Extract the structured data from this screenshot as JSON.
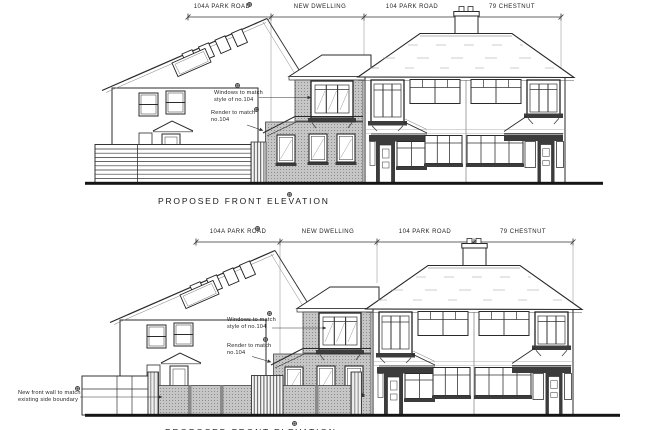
{
  "document": {
    "type": "architectural-elevation-drawing",
    "colors": {
      "line": "#2a2a2a",
      "render_gray": "#c6c6c6",
      "dark_band": "#3c3c3c",
      "ground": "#151515"
    },
    "panels": [
      {
        "title": "PROPOSED FRONT ELEVATION",
        "dimension_labels": [
          "104A PARK ROAD",
          "NEW DWELLING",
          "104 PARK ROAD",
          "79 CHESTNUT"
        ],
        "annotations": [
          {
            "lines": [
              "Windows to match",
              "style of no.104"
            ]
          },
          {
            "lines": [
              "Render to match",
              "no.104"
            ]
          }
        ]
      },
      {
        "title": "PROPOSED FRONT ELEVATION",
        "dimension_labels": [
          "104A PARK ROAD",
          "NEW DWELLING",
          "104 PARK ROAD",
          "79 CHESTNUT"
        ],
        "annotations": [
          {
            "lines": [
              "Windows to match",
              "style of no.104"
            ]
          },
          {
            "lines": [
              "Render to match",
              "no.104"
            ]
          },
          {
            "lines": [
              "New front wall to match",
              "existing side boundary"
            ]
          }
        ]
      }
    ]
  }
}
